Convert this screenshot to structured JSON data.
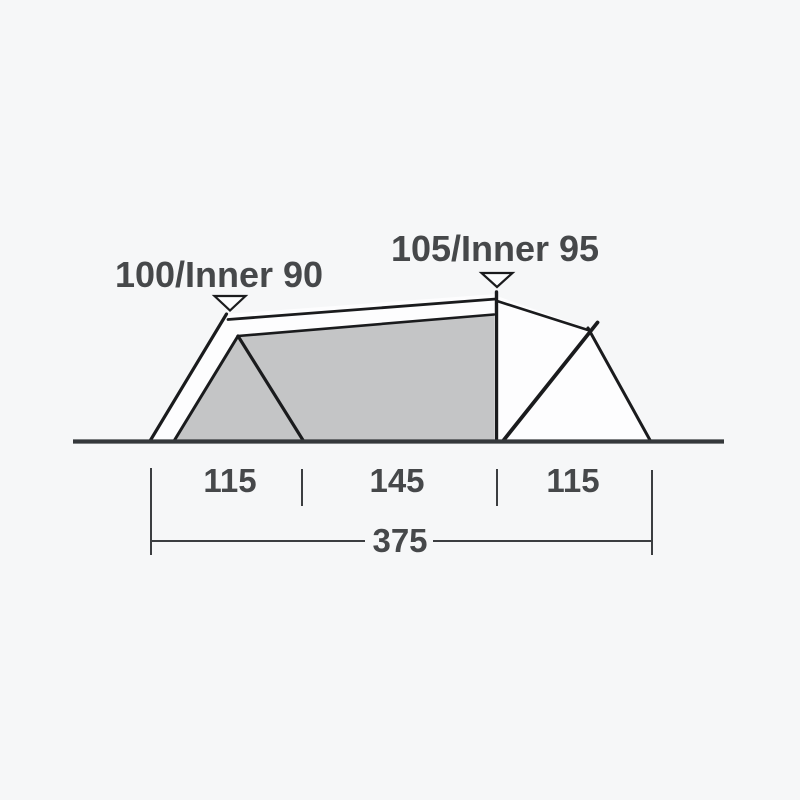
{
  "diagram": {
    "type": "tent-side-profile-dimensions",
    "labels": {
      "front_peak": "100/Inner 90",
      "main_peak": "105/Inner 95",
      "width_front": "115",
      "width_middle": "145",
      "width_rear": "115",
      "width_total": "375"
    },
    "values": {
      "front_peak_height": 100,
      "front_inner_height": 90,
      "main_peak_height": 105,
      "main_inner_height": 95,
      "section_widths": [
        115,
        145,
        115
      ],
      "total_width": 375
    },
    "icons": {
      "front_peak_marker": "triangle-down-icon",
      "main_peak_marker": "triangle-down-icon"
    },
    "colors": {
      "background": "#f6f7f8",
      "fly_white": "#fdfdfe",
      "inner_fill": "#c4c5c6",
      "frame_line": "#1a1b1d",
      "ground_line": "#35383b",
      "dimension_line": "#3c3e41",
      "text": "#46484a",
      "marker_fill": "#fbfcfd"
    }
  }
}
